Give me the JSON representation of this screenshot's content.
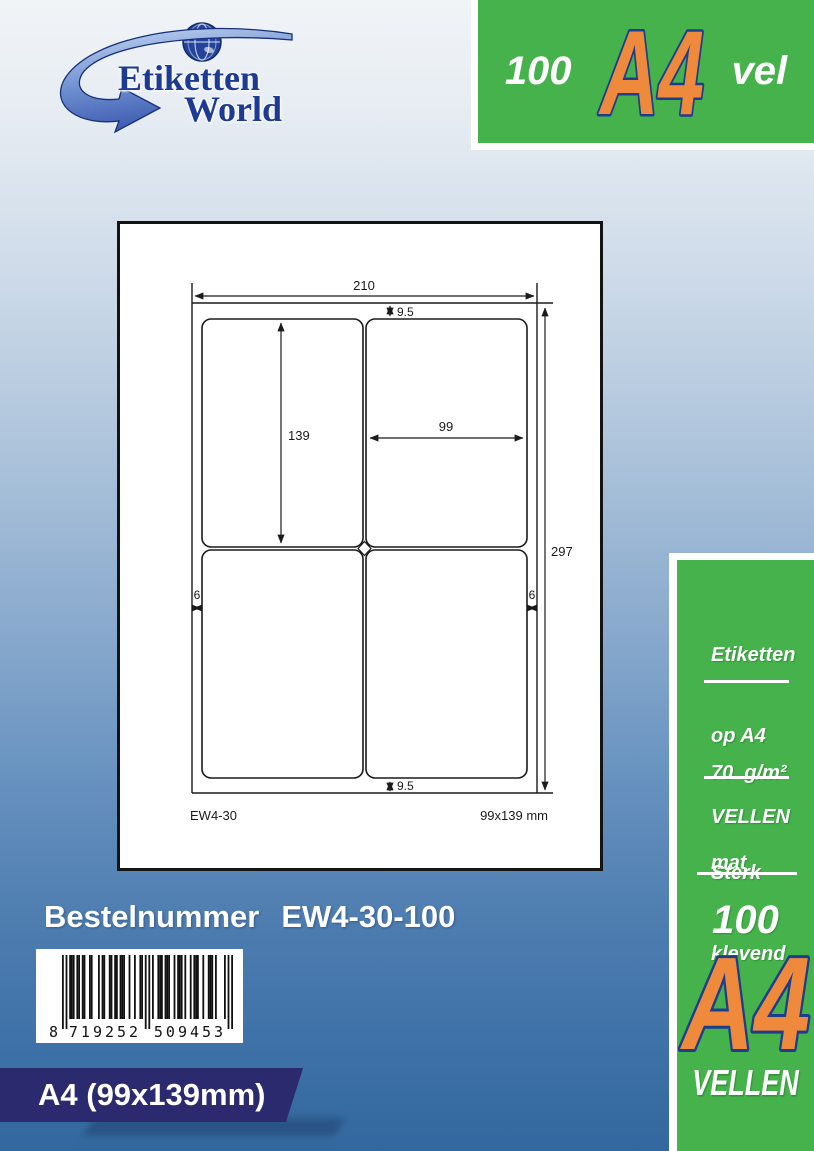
{
  "logo": {
    "word1": "Etiketten",
    "word2": "World"
  },
  "top_badge": {
    "count": "100",
    "format": "A4",
    "unit": "vel"
  },
  "sheet_diagram": {
    "width_mm": "210",
    "height_mm": "297",
    "top_margin_mm": "9.5",
    "bottom_margin_mm": "9.5",
    "label_height_mm": "139",
    "label_width_mm": "99",
    "left_margin_mm": "6",
    "right_margin_mm": "6",
    "product_code": "EW4-30",
    "label_format": "99x139 mm"
  },
  "side_panel": {
    "headline_line1": "Etiketten",
    "headline_line2": "op A4",
    "headline_line3": "VELLEN",
    "paper_weight": "70  g/m²",
    "paper_finish": "mat",
    "adhesive_line1": "Sterk",
    "adhesive_line2": "klevend",
    "count": "100",
    "format": "A4",
    "unit": "VELLEN"
  },
  "order": {
    "label": "Bestelnummer",
    "number": "EW4-30-100"
  },
  "barcode": {
    "digits": "8719252509453",
    "human_first": "8",
    "human_left": "719252",
    "human_right": "509453"
  },
  "footer": {
    "format_text": "A4 (99x139mm)"
  },
  "colors": {
    "green": "#46b24c",
    "orange": "#ef8a3c",
    "navy_outline": "#1e3d8f",
    "banner_navy": "#2b2a6e",
    "logo_navy": "#1d3a94",
    "background_top": "#f1f4f7",
    "background_bottom": "#32689f"
  }
}
